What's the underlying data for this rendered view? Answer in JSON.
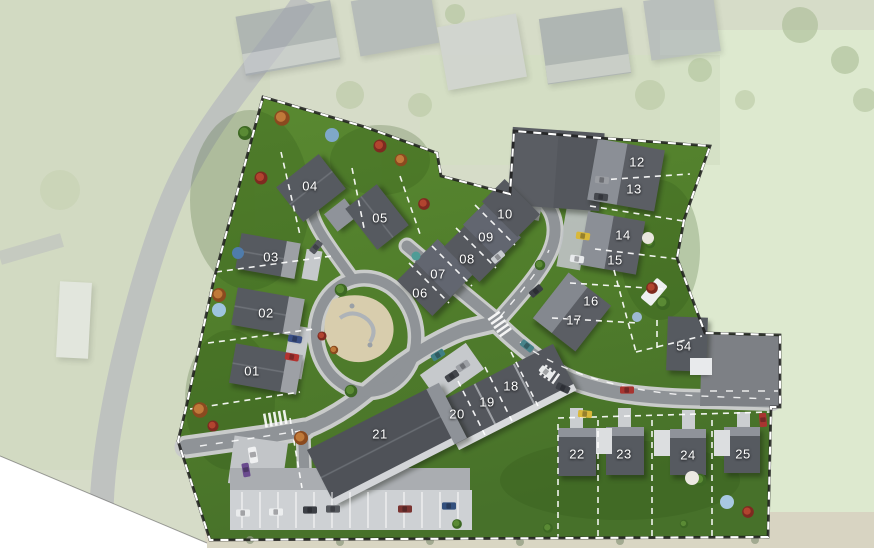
{
  "map": {
    "kind": "residential-development-site-plan",
    "plots": [
      {
        "label": "01",
        "x": 252,
        "y": 371
      },
      {
        "label": "02",
        "x": 266,
        "y": 313
      },
      {
        "label": "03",
        "x": 271,
        "y": 257
      },
      {
        "label": "04",
        "x": 310,
        "y": 186
      },
      {
        "label": "05",
        "x": 380,
        "y": 218
      },
      {
        "label": "06",
        "x": 420,
        "y": 293
      },
      {
        "label": "07",
        "x": 438,
        "y": 274
      },
      {
        "label": "08",
        "x": 467,
        "y": 259
      },
      {
        "label": "09",
        "x": 486,
        "y": 237
      },
      {
        "label": "10",
        "x": 505,
        "y": 214
      },
      {
        "label": "12",
        "x": 637,
        "y": 162
      },
      {
        "label": "13",
        "x": 634,
        "y": 189
      },
      {
        "label": "14",
        "x": 623,
        "y": 235
      },
      {
        "label": "15",
        "x": 615,
        "y": 260
      },
      {
        "label": "16",
        "x": 591,
        "y": 301
      },
      {
        "label": "17",
        "x": 574,
        "y": 320
      },
      {
        "label": "54",
        "x": 684,
        "y": 346
      },
      {
        "label": "18",
        "x": 511,
        "y": 386
      },
      {
        "label": "19",
        "x": 487,
        "y": 402
      },
      {
        "label": "20",
        "x": 457,
        "y": 414
      },
      {
        "label": "21",
        "x": 380,
        "y": 434
      },
      {
        "label": "22",
        "x": 577,
        "y": 454
      },
      {
        "label": "23",
        "x": 624,
        "y": 454
      },
      {
        "label": "24",
        "x": 688,
        "y": 455
      },
      {
        "label": "25",
        "x": 743,
        "y": 454
      }
    ],
    "palette": {
      "site_grass": "#53812e",
      "faded_grass": "#d6dcc8",
      "mint_field": "#dde9cf",
      "road": "#8f9397",
      "sidewalk": "#c9cbca",
      "roof_dark": "#565a60",
      "roof_light": "#8b8f96",
      "plaza": "#7d8085",
      "parking": "#ced1d4",
      "playground": "#d8cdad",
      "boundary_dash": "#ffffff",
      "lot_line_dash": "#ffffff",
      "label_text": "#ffffff"
    }
  }
}
